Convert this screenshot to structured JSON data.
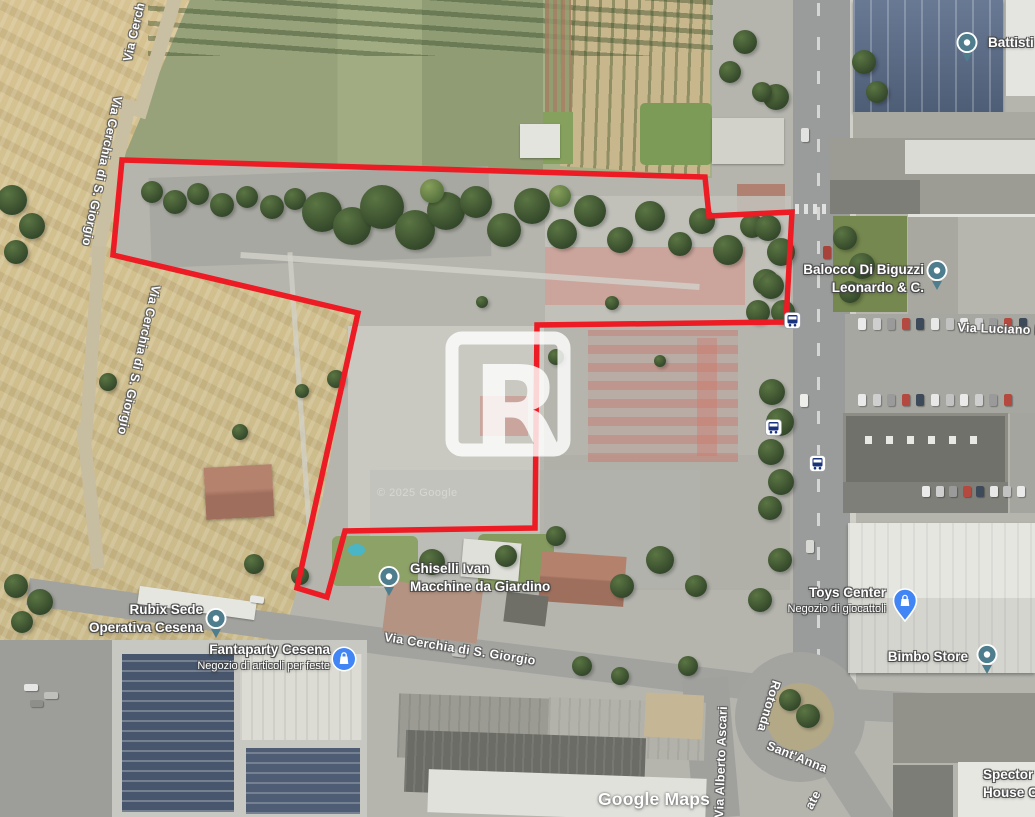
{
  "app": {
    "name": "Google Maps satellite view with parcel outline"
  },
  "attribution": {
    "logo": "Google Maps",
    "copyright": "© 2025 Google"
  },
  "watermark": {
    "letter": "R"
  },
  "parcel_outline": {
    "color": "#ec1b24",
    "points": "122,160 705,177 709,216 792,212 786,322 537,325 535,528 345,531 327,597 297,588 358,313 113,255"
  },
  "pois": [
    {
      "id": "battisti",
      "icon": "place-pin",
      "pin": {
        "x": 968,
        "y": 44
      },
      "label": {
        "x": 988,
        "y": 34,
        "align": "left"
      },
      "lines": [
        {
          "text": "Battisti",
          "style": "primary"
        }
      ]
    },
    {
      "id": "balocco",
      "icon": "place-pin",
      "pin": {
        "x": 938,
        "y": 272
      },
      "label": {
        "x": 924,
        "y": 261,
        "align": "right"
      },
      "lines": [
        {
          "text": "Balocco Di Biguzzi",
          "style": "primary"
        },
        {
          "text": "Leonardo & C.",
          "style": "primary"
        }
      ]
    },
    {
      "id": "ghiselli",
      "icon": "place-pin",
      "pin": {
        "x": 390,
        "y": 578
      },
      "label": {
        "x": 410,
        "y": 560,
        "align": "left"
      },
      "lines": [
        {
          "text": "Ghiselli Ivan",
          "style": "primary"
        },
        {
          "text": "Macchine da Giardino",
          "style": "primary"
        }
      ]
    },
    {
      "id": "rubix",
      "icon": "place-pin",
      "pin": {
        "x": 217,
        "y": 620
      },
      "label": {
        "x": 203,
        "y": 601,
        "align": "right"
      },
      "lines": [
        {
          "text": "Rubix Sede",
          "style": "primary"
        },
        {
          "text": "Operativa Cesena",
          "style": "primary"
        }
      ]
    },
    {
      "id": "fantaparty",
      "icon": "shopping-circle",
      "pin": {
        "x": 344,
        "y": 659
      },
      "label": {
        "x": 330,
        "y": 641,
        "align": "right"
      },
      "lines": [
        {
          "text": "Fantaparty Cesena",
          "style": "primary"
        },
        {
          "text": "Negozio di articoli per feste",
          "style": "secondary"
        }
      ]
    },
    {
      "id": "toys-center",
      "icon": "shopping-pin",
      "pin": {
        "x": 905,
        "y": 601
      },
      "label": {
        "x": 886,
        "y": 584,
        "align": "right"
      },
      "lines": [
        {
          "text": "Toys Center",
          "style": "primary"
        },
        {
          "text": "Negozio di giocattoli",
          "style": "secondary"
        }
      ]
    },
    {
      "id": "bimbo-store",
      "icon": "place-pin",
      "pin": {
        "x": 988,
        "y": 656
      },
      "label": {
        "x": 968,
        "y": 648,
        "align": "right"
      },
      "lines": [
        {
          "text": "Bimbo Store",
          "style": "primary"
        }
      ]
    },
    {
      "id": "spector",
      "icon": "none",
      "pin": null,
      "label": {
        "x": 983,
        "y": 766,
        "align": "left"
      },
      "lines": [
        {
          "text": "Spector P",
          "style": "primary"
        },
        {
          "text": "House Ce",
          "style": "primary"
        }
      ]
    }
  ],
  "road_labels": [
    {
      "text": "Via Cerch",
      "x": 134,
      "y": 32,
      "rotate": -77
    },
    {
      "text": "Via Cerchia di S. Giorgio",
      "x": 102,
      "y": 171,
      "rotate": 102
    },
    {
      "text": "Via Cerchia di S. Giorgio",
      "x": 139,
      "y": 360,
      "rotate": 103
    },
    {
      "text": "Via Cerchia di S. Giorgio",
      "x": 460,
      "y": 649,
      "rotate": 9
    },
    {
      "text": "Via Luciano L",
      "x": 1000,
      "y": 329,
      "rotate": 2
    },
    {
      "text": "Rotonda",
      "x": 769,
      "y": 706,
      "rotate": 107
    },
    {
      "text": "Sant'Anna",
      "x": 797,
      "y": 757,
      "rotate": 22
    },
    {
      "text": "Via Alberto Ascari",
      "x": 721,
      "y": 762,
      "rotate": -88
    },
    {
      "text": "ate",
      "x": 813,
      "y": 800,
      "rotate": -62
    }
  ],
  "transit_stops": [
    {
      "icon": "bus",
      "x": 792,
      "y": 320
    },
    {
      "icon": "bus",
      "x": 773,
      "y": 427
    },
    {
      "icon": "bus",
      "x": 817,
      "y": 463
    }
  ],
  "colors": {
    "parcel": "#ec1b24",
    "place_pin": "#4e7d8d",
    "shopping_pin": "#4285f4",
    "bus_glyph": "#18327c"
  }
}
